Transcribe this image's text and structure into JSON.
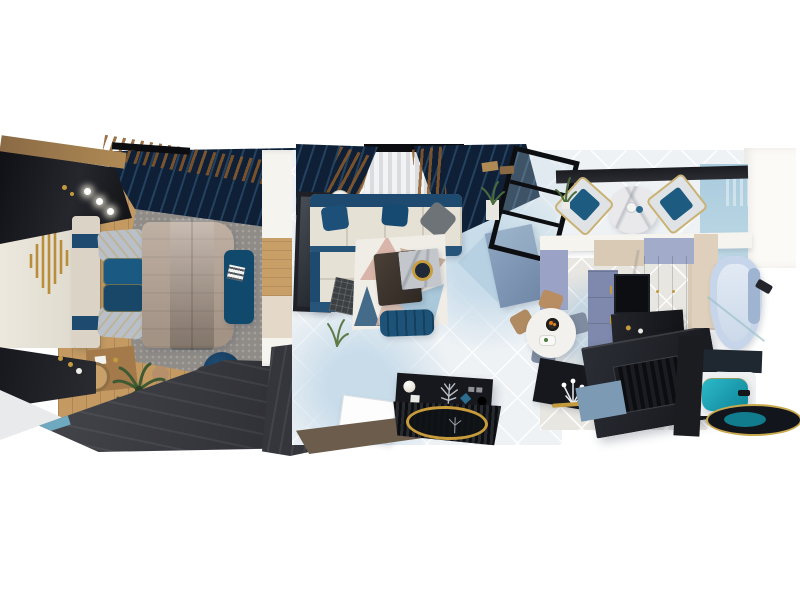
{
  "meta": {
    "type": "3d-interior-render",
    "view": "top-down bird's-eye 3D rendering of a modern apartment on a white background",
    "style": "navy blue, cream, taupe, grey and gold palette",
    "visible_text": ""
  },
  "palette": {
    "bg": "#ffffff",
    "navy_dark": "#0f2036",
    "navy_mid": "#24425f",
    "navy": "#1d4a6e",
    "bed_blue": "#1a5a82",
    "bed_blue_dark": "#10405f",
    "bench_navy": "#11496d",
    "gold": "#c49a3f",
    "bronze": "#8a5a28",
    "cream": "#e6e1d5",
    "cream_wall": "#ece8dd",
    "headboard": "#dbd4c6",
    "taupe": "#b19f90",
    "rug_gray": "#8f8c88",
    "rug_gray_hi": "#a5a19d",
    "wood": "#c49a62",
    "wood_dark": "#8a6a45",
    "walkway": "#3f4046",
    "dark": "#17181d",
    "black": "#0c0d10",
    "tile": "#eef2f5",
    "tile_blue": "#c8dcea",
    "rug_white": "#f0ede7",
    "blush": "#d8b5a8",
    "rug_beige": "#c9b29b",
    "rug_blue": "#a9c8da",
    "rug_navy": "#27547a",
    "marble_gray": "#c3c6cb",
    "gray_pillow": "#6e7378",
    "silver": "#b9c0c9",
    "dining_marble": "#e9e9eb",
    "chair_frame": "#dfe3e6",
    "chair_navy": "#1d5c80",
    "blue_wall": "#a9cbdd",
    "blue_wall_light": "#bfd9e6",
    "beam": "#1b1c20",
    "lavender": "#9aa3c6",
    "kblue": "#7e89ad",
    "kblue_tall": "#8f99bd",
    "cab_beige": "#d9cab5",
    "kcounter": "#23252b",
    "screen": "#0d0e12",
    "kfloor": "#e8e6e1",
    "peninsula": "#8fa7c2",
    "bath_marble": "#ddd2c5",
    "bath_marble2": "#cbbfae",
    "tub": "#c7d5ea",
    "tub_inner": "#e2eaf4",
    "tub_trim": "#9fb4d1",
    "teal": "#17a9bd",
    "teal_dark": "#0e8496",
    "mirror_dark": "#12161c",
    "pink": "#e03ad2",
    "green": "#3e5a33",
    "off_white": "#f6f4ef"
  },
  "rooms": {
    "bedroom": {
      "furniture": [
        "dark wardrobe with spotlights",
        "navy-gold drapes",
        "cream wall with gold art sculpture",
        "upholstered bed with taupe duvet and blue runner",
        "grey shag rug",
        "navy foot bench with magazine",
        "round navy pouf",
        "two-tone foot bench with slippers and pink flowers",
        "oval glass tray",
        "wood vanity with stool",
        "dark console",
        "palm plant",
        "dark diagonal walkway"
      ]
    },
    "living_room": {
      "furniture": [
        "sheer window with navy-gold drapes",
        "wall TV panel",
        "floor lamp",
        "L-shaped cream sectional with navy base and pillows",
        "waffle throw",
        "geometric triangle rug",
        "navy channel ottoman",
        "dark wood and marble coffee tables with gold bowl",
        "black media console with decor",
        "ribbed black mat with gold ring mirror",
        "open black-framed glass door",
        "plant on pedestal"
      ]
    },
    "dining": {
      "furniture": [
        "dark ceiling beam",
        "round marble dining table",
        "two gold-framed chairs with navy cushions",
        "potted plant",
        "light blue curtain wall"
      ]
    },
    "kitchen": {
      "furniture": [
        "lavender and beige cabinets",
        "blue-grey cabinet fronts",
        "dark built-in screen",
        "marble column",
        "dark counter",
        "round white table with fruit bowl and plate",
        "four chairs",
        "dark island with white flowers",
        "gold faucet",
        "large dark counter with ribbed hob",
        "blue-grey peninsula"
      ]
    },
    "bathroom": {
      "furniture": [
        "corner shower tub with glass",
        "shower head",
        "beige marble walls",
        "dark vanity counter",
        "teal sink",
        "gold-rimmed round mirror"
      ]
    }
  }
}
